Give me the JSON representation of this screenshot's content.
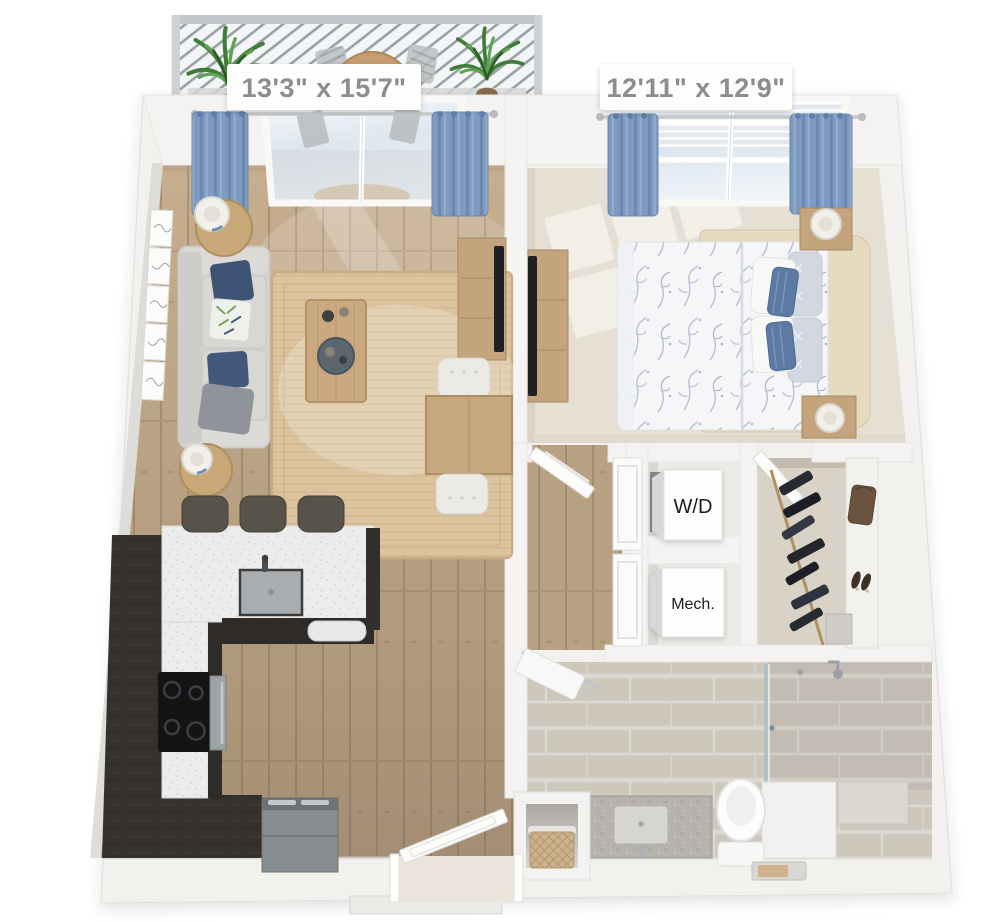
{
  "labels": {
    "living_room_dimensions": "13'3\" x 15'7\"",
    "bedroom_dimensions": "12'11\" x 12'9\"",
    "washer_dryer": "W/D",
    "mechanical": "Mech."
  },
  "palette": {
    "background": "#ffffff",
    "wall": "#f2f1ee",
    "wall_shadow": "#dbd9d5",
    "wood_floor": "#c6ae8e",
    "wood_floor_dark": "#a8907a",
    "carpet": "#e6dfd4",
    "tile": "#cdc7bc",
    "curtain_blue": "#7e9ac0",
    "accent_navy": "#3c5374",
    "sofa_gray": "#d5d3cf",
    "cabinet_dark": "#332f2c",
    "counter_white": "#ececed",
    "vanity_counter": "#b6b3af",
    "furniture_wood": "#c3a47c",
    "rug_jute": "#dcc49f",
    "headboard_cream": "#e6dabf",
    "plant_green": "#3e7c38",
    "closet_floor": "#d9d2c6",
    "appliance_gray": "#888d90",
    "label_text": "#8d8d8d"
  }
}
